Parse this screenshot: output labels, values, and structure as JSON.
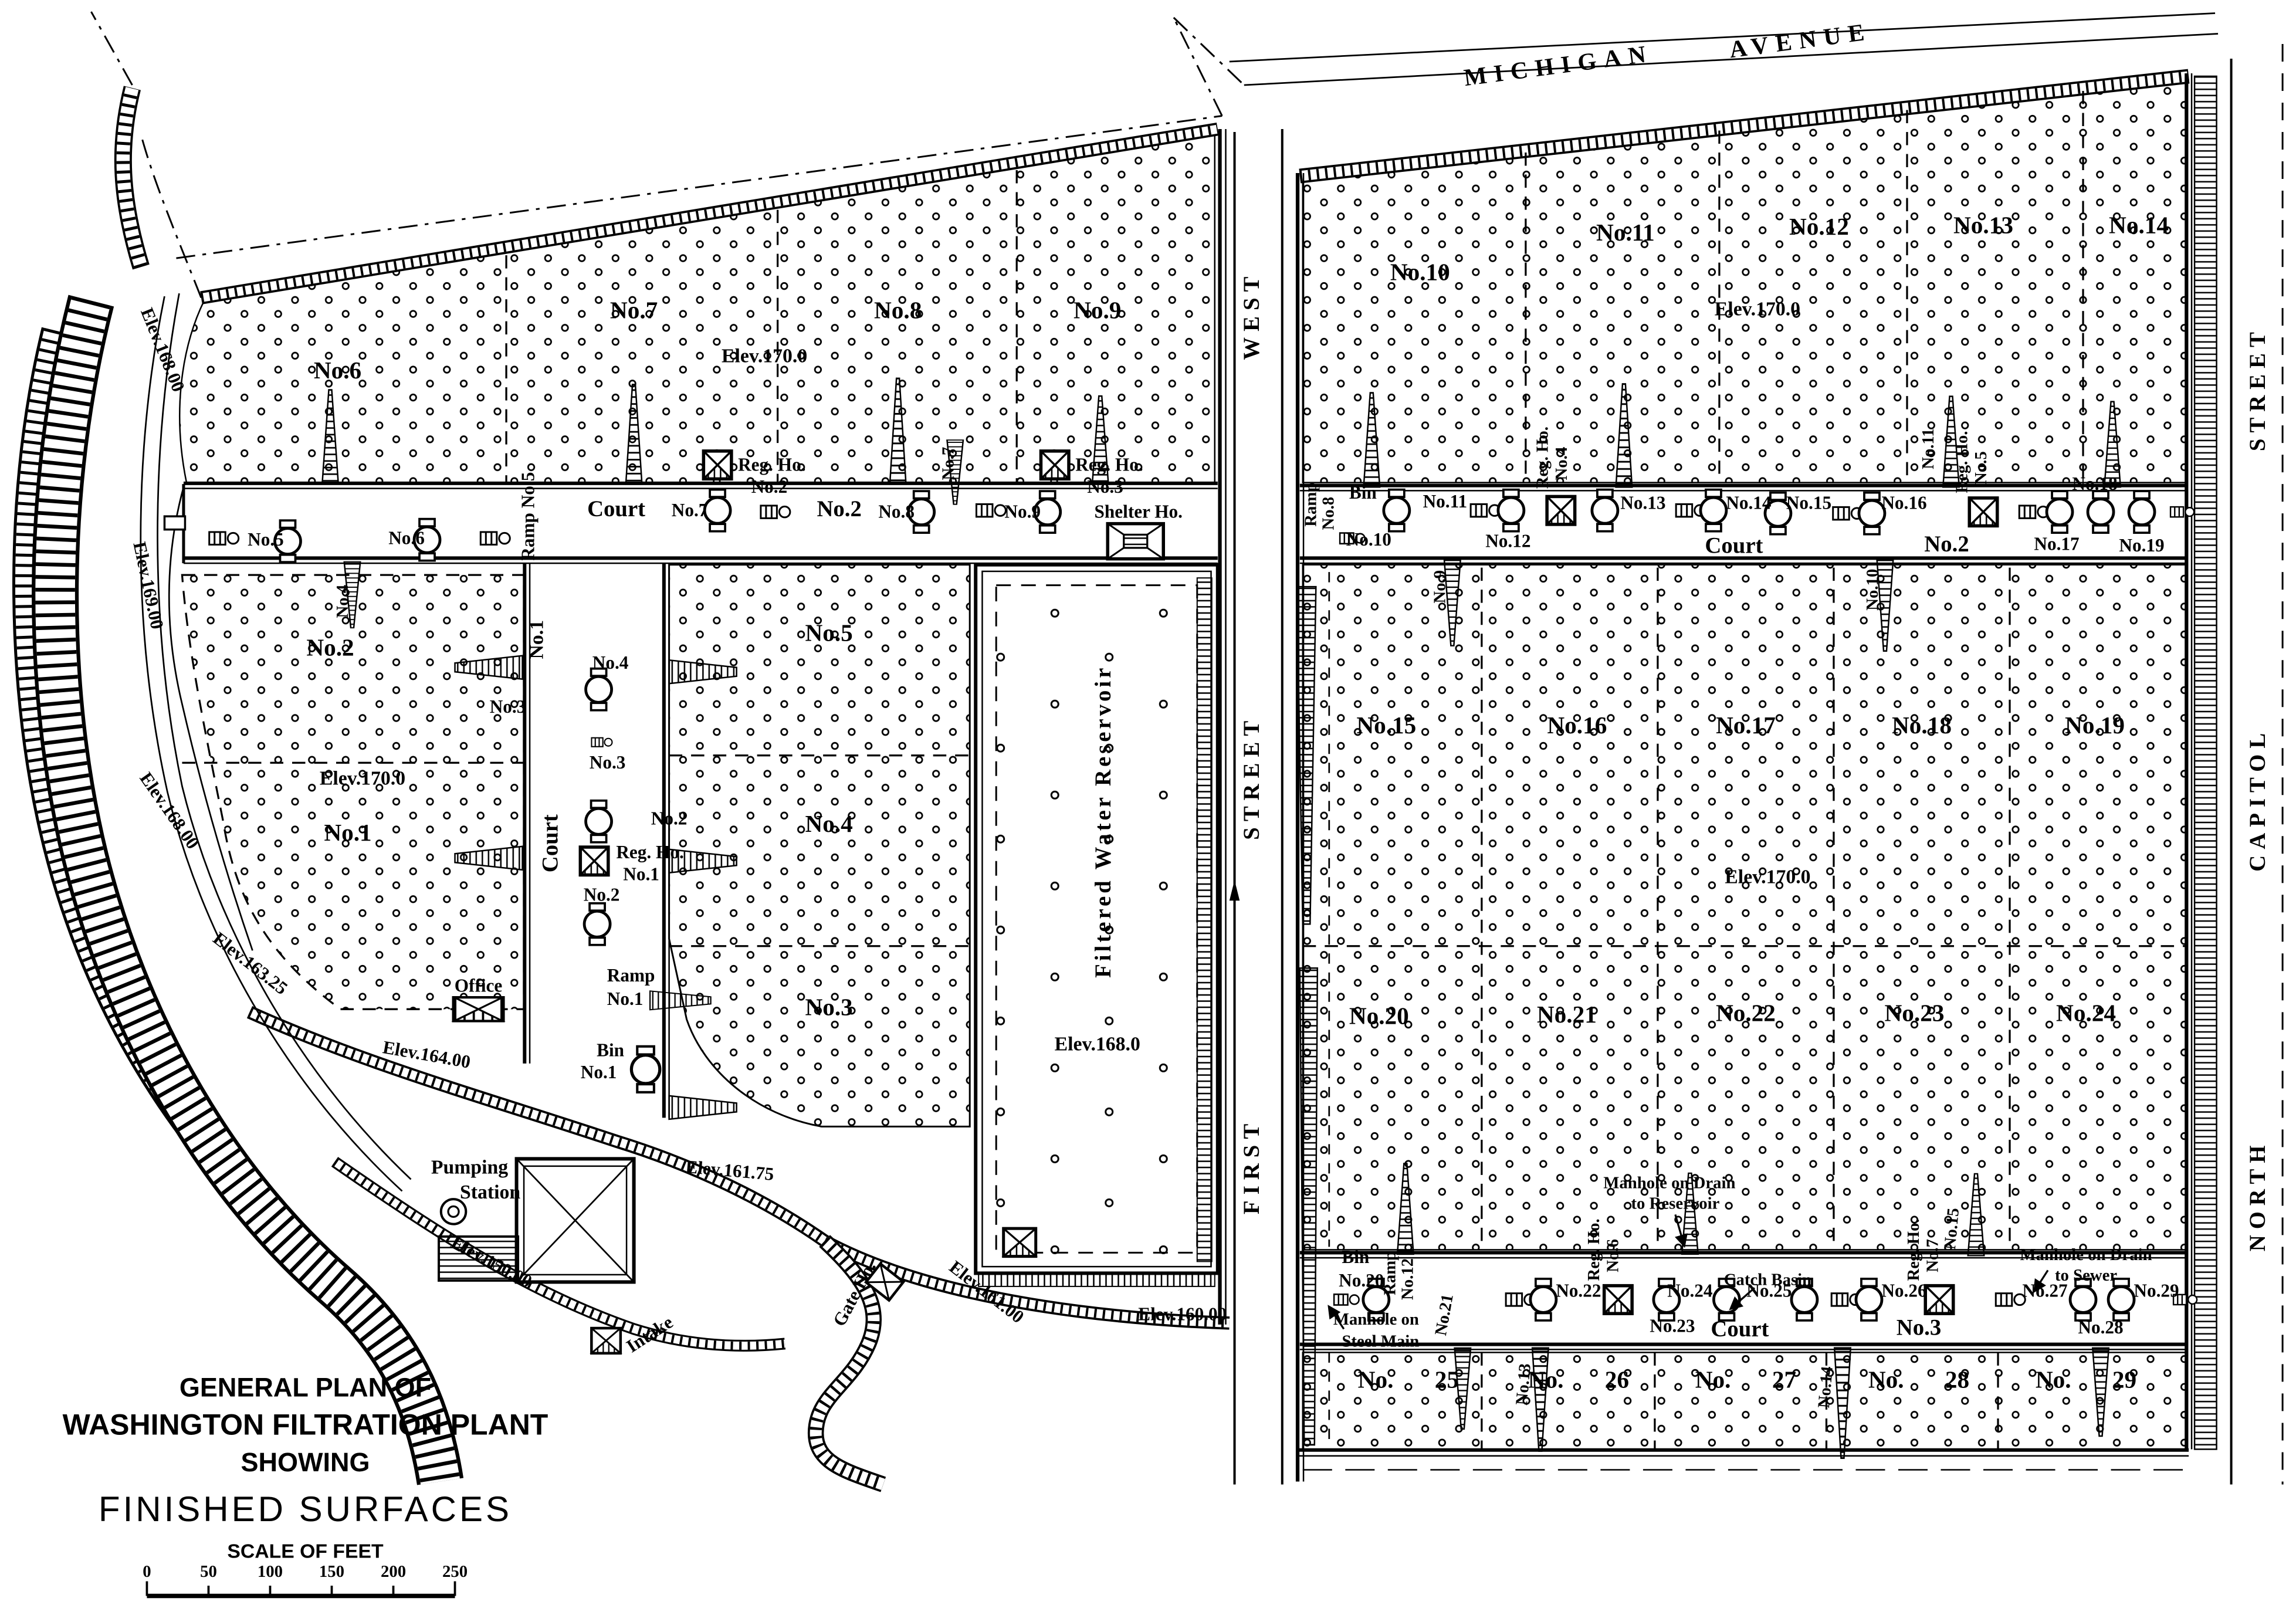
{
  "title_block": {
    "line1": "GENERAL PLAN OF",
    "line2": "WASHINGTON FILTRATION PLANT",
    "line3": "SHOWING",
    "line4": "FINISHED SURFACES",
    "scale_label": "SCALE OF FEET",
    "ticks": [
      "0",
      "50",
      "100",
      "150",
      "200",
      "250"
    ]
  },
  "streets": {
    "michigan_1": "MICHIGAN",
    "michigan_2": "AVENUE",
    "first_1": "FIRST",
    "first_2": "STREET",
    "first_3": "WEST",
    "ncap_1": "NORTH",
    "ncap_2": "CAPITOL",
    "ncap_3": "STREET"
  },
  "west": {
    "beds": {
      "b1": "No.1",
      "b2": "No.2",
      "b3": "No.3",
      "b4": "No.4",
      "b5": "No.5",
      "b6": "No.6",
      "b7": "No.7",
      "b8": "No.8",
      "b9": "No.9",
      "elev_top": "Elev.170.0",
      "elev_left": "Elev.170.0"
    },
    "court2": {
      "ramp5": "Ramp No.5",
      "court": "Court",
      "bin7": "No.7",
      "regho2a": "Reg. Ho.",
      "regho2b": "No.2",
      "no2": "No.2",
      "bin8": "No.8",
      "ramp7": "No.7",
      "regho3a": "Reg. Ho.",
      "regho3b": "No.3",
      "bin9": "No.9",
      "shelter": "Shelter Ho."
    },
    "side": {
      "bin5": "No.5",
      "bin6": "No.6",
      "ramp4": "No.4"
    },
    "court1": {
      "no1": "No.1",
      "court": "Court",
      "bin4": "No.4",
      "ramp3": "No.3",
      "bin3": "No.3",
      "ramp2": "No.2",
      "regho1a": "Reg. Ho.",
      "regho1b": "No.1",
      "bin2": "No.2",
      "ramp1a": "Ramp",
      "ramp1b": "No.1",
      "bin1a": "Bin",
      "bin1b": "No.1"
    },
    "reservoir": {
      "name": "Filtered Water Reservoir",
      "elev": "Elev.168.0"
    },
    "buildings": {
      "office": "Office",
      "pumping1": "Pumping",
      "pumping2": "Station",
      "gate": "Gate Ho.",
      "intake": "Intake"
    },
    "elev": {
      "r1": "Elev.168.00",
      "r2": "Elev.169.00",
      "r3": "Elev.168.00",
      "e16325": "Elev.163.25",
      "e16400": "Elev.164.00",
      "e15000": "Elev.150.00",
      "e16175": "Elev.161.75",
      "e16100": "Elev.161.00",
      "e16000": "Elev.160.00"
    }
  },
  "east": {
    "beds": {
      "b10": "No.10",
      "b11": "No.11",
      "b12": "No.12",
      "b13": "No.13",
      "b14": "No.14",
      "b15": "No.15",
      "b16": "No.16",
      "b17": "No.17",
      "b18": "No.18",
      "b19": "No.19",
      "b20": "No.20",
      "b21": "No.21",
      "b22": "No.22",
      "b23": "No.23",
      "b24": "No.24",
      "b25": "No. 25",
      "b26": "No. 26",
      "b27": "No. 27",
      "b28": "No. 28",
      "b29": "No. 29",
      "elev_top": "Elev.170.0",
      "elev_mid": "Elev.170.0"
    },
    "court2": {
      "ramp8a": "Ramp",
      "ramp8b": "No.8",
      "bin": "Bin",
      "no10": "No.10",
      "no11": "No.11",
      "no12": "No.12",
      "regho4a": "Reg. Ho.",
      "regho4b": "No.4",
      "no13": "No.13",
      "no14": "No.14",
      "court": "Court",
      "no15": "No.15",
      "no16": "No.16",
      "ramp11": "No.11",
      "regho5a": "Reg. Ho.",
      "regho5b": "No.5",
      "no2": "No.2",
      "no17": "No.17",
      "no18": "No.18",
      "no19": "No.19",
      "ramp9": "No.9",
      "ramp10": "No.10"
    },
    "court3": {
      "bina": "Bin",
      "binb": "No.20",
      "ramp12a": "Ramp",
      "ramp12b": "No.12",
      "no21": "No.21",
      "no22": "No.22",
      "regho6a": "Reg. Ho.",
      "regho6b": "No.6",
      "no23": "No.23",
      "mhres1": "Manhole on Drain",
      "mhres2": "to Reservoir",
      "catch": "Catch Basin",
      "no24": "No.24",
      "no25": "No.25",
      "court": "Court",
      "no3": "No.3",
      "no26": "No.26",
      "regho7a": "Reg. Ho.",
      "regho7b": "No.7",
      "ramp15": "No.15",
      "mhsew1": "Manhole on Drain",
      "mhsew2": "to Sewer",
      "no27": "No.27",
      "no28": "No.28",
      "no29": "No.29",
      "mhmain1": "Manhole on",
      "mhmain2": "Steel Main",
      "ramp13": "No.13",
      "ramp14": "No.14"
    }
  }
}
